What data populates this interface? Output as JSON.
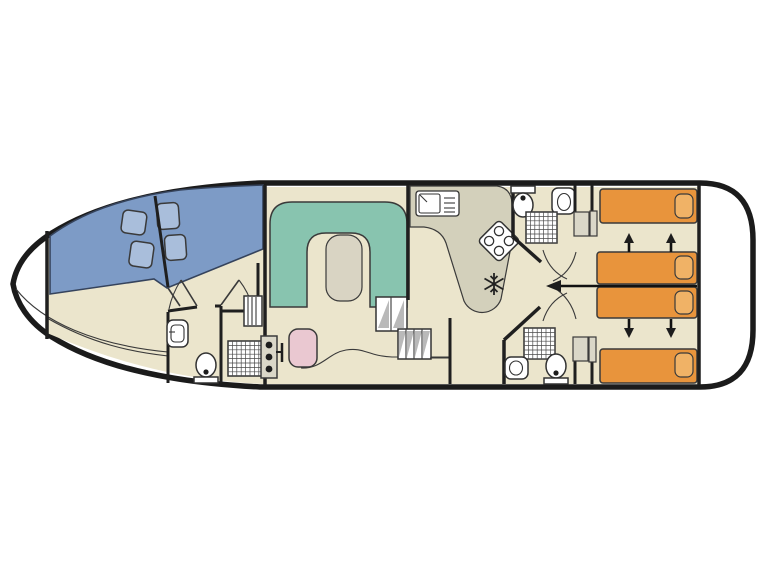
{
  "plan": {
    "type": "boat-deck-floorplan",
    "orientation": "bow-left-stern-right"
  },
  "colors": {
    "background": "#ffffff",
    "hull_outline": "#1b1b1b",
    "deck_white": "#ffffff",
    "floor_cream": "#ebe5cc",
    "bed_blue": "#7d9bc6",
    "pillow_blue": "#a9bedb",
    "sofa_teal": "#88c4af",
    "table_top": "#d9d4c3",
    "counter_khaki": "#d3d0bb",
    "bed_orange": "#e8943c",
    "pillow_orange": "#f0b266",
    "helm_seat_pink": "#eac8d1",
    "cabinet_grey": "#dad7c8",
    "fixture_white": "#ffffff",
    "shower_floor": "#f2f2ee"
  },
  "icons": {
    "fridge_icon": "snowflake",
    "stove_icon": "four-burner-hob",
    "toilet_icon": "toilet-top-view",
    "sink_icon": "washbasin-top-view",
    "shower_icon": "hatched-shower-tray",
    "stairs_icon": "hatched-steps",
    "slide_bed_icon": "up-down-arrows",
    "sliding_partition_icon": "left-arrow-line"
  }
}
